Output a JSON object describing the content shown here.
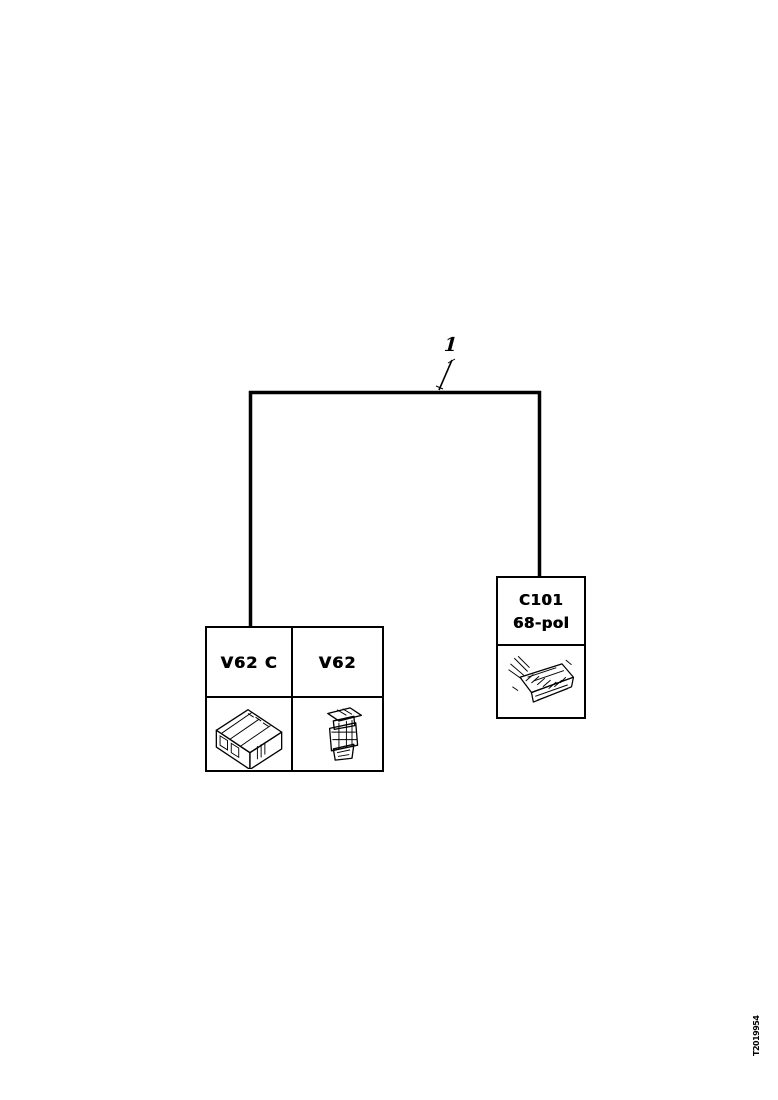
{
  "page": {
    "background_color": "#ffffff",
    "ink_color": "#000000"
  },
  "callout": {
    "label": "1"
  },
  "component_box": {
    "cells": [
      {
        "label": "V62 C"
      },
      {
        "label": "V62"
      }
    ],
    "images": [
      {
        "name": "control-module-illustration"
      },
      {
        "name": "solenoid-valve-illustration"
      }
    ]
  },
  "connector_box": {
    "line1": "C101",
    "line2": "68-pol",
    "image": {
      "name": "68-pin-connector-illustration"
    }
  },
  "footer": {
    "drawing_id": "T2019954"
  }
}
